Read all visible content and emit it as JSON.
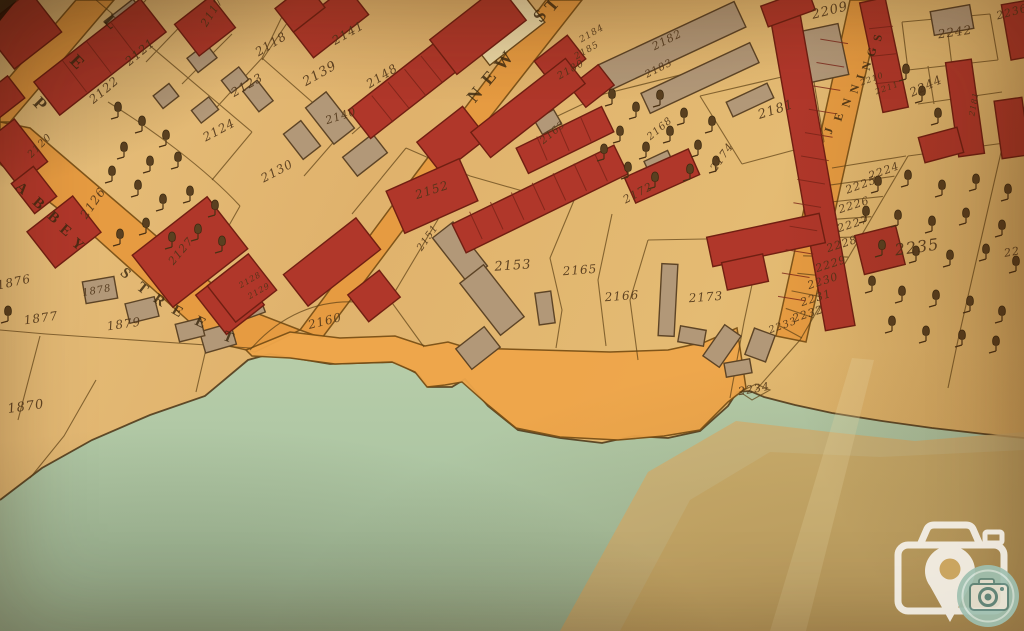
{
  "map": {
    "colors": {
      "parchment": "#e2ba74",
      "road": "#e79a3f",
      "quay": "#efa64a",
      "building_red": "#b0372a",
      "building_tan": "#b29878",
      "building_cream": "#ecd9a6",
      "water": "#b2c8a5",
      "crease": "#d3b172",
      "ink": "#4e3418",
      "boundary_line": "#5d4015",
      "watermark_white": "#ffffff",
      "watermark_teal": "#9fc0b0"
    },
    "streets": [
      {
        "name": "ABBEY STREET",
        "letters": [
          {
            "ch": "A",
            "x": 21,
            "y": 189,
            "r": 42,
            "s": 15
          },
          {
            "ch": "B",
            "x": 38,
            "y": 204,
            "r": 42,
            "s": 15
          },
          {
            "ch": "B",
            "x": 53,
            "y": 218,
            "r": 42,
            "s": 15
          },
          {
            "ch": "E",
            "x": 65,
            "y": 231,
            "r": 40,
            "s": 15
          },
          {
            "ch": "Y",
            "x": 77,
            "y": 245,
            "r": 40,
            "s": 15
          },
          {
            "ch": "S",
            "x": 125,
            "y": 274,
            "r": 40,
            "s": 15
          },
          {
            "ch": "T",
            "x": 142,
            "y": 289,
            "r": 38,
            "s": 15
          },
          {
            "ch": "R",
            "x": 159,
            "y": 301,
            "r": 34,
            "s": 15
          },
          {
            "ch": "E",
            "x": 177,
            "y": 312,
            "r": 30,
            "s": 15
          },
          {
            "ch": "E",
            "x": 200,
            "y": 323,
            "r": 26,
            "s": 15
          },
          {
            "ch": "T",
            "x": 228,
            "y": 338,
            "r": 22,
            "s": 15
          }
        ]
      },
      {
        "name": "NEW ST",
        "letters": [
          {
            "ch": "N",
            "x": 475,
            "y": 95,
            "r": -50,
            "s": 18
          },
          {
            "ch": "E",
            "x": 489,
            "y": 78,
            "r": -50,
            "s": 18
          },
          {
            "ch": "W",
            "x": 504,
            "y": 61,
            "r": -50,
            "s": 18
          },
          {
            "ch": "S",
            "x": 540,
            "y": 16,
            "r": -50,
            "s": 18
          },
          {
            "ch": "T",
            "x": 552,
            "y": 5,
            "r": -50,
            "s": 18
          }
        ]
      },
      {
        "name": "JENNINGS",
        "letters": [
          {
            "ch": "J",
            "x": 829,
            "y": 131,
            "r": -72,
            "s": 12
          },
          {
            "ch": "E",
            "x": 839,
            "y": 117,
            "r": -73,
            "s": 12
          },
          {
            "ch": "N",
            "x": 847,
            "y": 103,
            "r": -74,
            "s": 12
          },
          {
            "ch": "N",
            "x": 855,
            "y": 89,
            "r": -75,
            "s": 12
          },
          {
            "ch": "I",
            "x": 861,
            "y": 77,
            "r": -75,
            "s": 12
          },
          {
            "ch": "N",
            "x": 867,
            "y": 66,
            "r": -76,
            "s": 12
          },
          {
            "ch": "G",
            "x": 872,
            "y": 52,
            "r": -77,
            "s": 12
          },
          {
            "ch": "S",
            "x": 878,
            "y": 38,
            "r": -78,
            "s": 12
          }
        ]
      },
      {
        "name": "P E L",
        "letters": [
          {
            "ch": "P",
            "x": 40,
            "y": 104,
            "r": 45,
            "s": 18
          },
          {
            "ch": "E",
            "x": 77,
            "y": 62,
            "r": 45,
            "s": 18
          },
          {
            "ch": "L",
            "x": 111,
            "y": 22,
            "r": 45,
            "s": 18
          }
        ]
      }
    ],
    "parcels": [
      {
        "n": "2117",
        "x": 212,
        "y": 12,
        "r": -58,
        "s": 11
      },
      {
        "n": "2118",
        "x": 271,
        "y": 44,
        "r": -32,
        "s": 12
      },
      {
        "n": "2121",
        "x": 140,
        "y": 52,
        "r": -40,
        "s": 12
      },
      {
        "n": "2122",
        "x": 104,
        "y": 90,
        "r": -40,
        "s": 12
      },
      {
        "n": "2123",
        "x": 247,
        "y": 85,
        "r": -30,
        "s": 12
      },
      {
        "n": "2124",
        "x": 219,
        "y": 130,
        "r": -28,
        "s": 12
      },
      {
        "n": "2130",
        "x": 277,
        "y": 171,
        "r": -28,
        "s": 12
      },
      {
        "n": "2139",
        "x": 320,
        "y": 74,
        "r": -30,
        "s": 13
      },
      {
        "n": "2141",
        "x": 348,
        "y": 33,
        "r": -30,
        "s": 12
      },
      {
        "n": "2148",
        "x": 382,
        "y": 76,
        "r": -32,
        "s": 12
      },
      {
        "n": "2140",
        "x": 341,
        "y": 116,
        "r": -18,
        "s": 11
      },
      {
        "n": "2120",
        "x": 40,
        "y": 146,
        "r": -45,
        "s": 10
      },
      {
        "n": "2126",
        "x": 93,
        "y": 203,
        "r": -55,
        "s": 12
      },
      {
        "n": "2127",
        "x": 181,
        "y": 251,
        "r": -50,
        "s": 11
      },
      {
        "n": "2128",
        "x": 250,
        "y": 280,
        "r": -30,
        "s": 8
      },
      {
        "n": "2129",
        "x": 259,
        "y": 291,
        "r": -30,
        "s": 8
      },
      {
        "n": "1876",
        "x": 14,
        "y": 282,
        "r": -12,
        "s": 12
      },
      {
        "n": "1877",
        "x": 41,
        "y": 318,
        "r": -8,
        "s": 12
      },
      {
        "n": "1878",
        "x": 97,
        "y": 291,
        "r": -10,
        "s": 10
      },
      {
        "n": "1879",
        "x": 124,
        "y": 324,
        "r": -8,
        "s": 12
      },
      {
        "n": "1870",
        "x": 26,
        "y": 407,
        "r": -8,
        "s": 13
      },
      {
        "n": "2160",
        "x": 325,
        "y": 321,
        "r": -14,
        "s": 12
      },
      {
        "n": "2151",
        "x": 428,
        "y": 238,
        "r": -55,
        "s": 10
      },
      {
        "n": "2152",
        "x": 432,
        "y": 190,
        "r": -18,
        "s": 12
      },
      {
        "n": "2153",
        "x": 513,
        "y": 266,
        "r": -4,
        "s": 13
      },
      {
        "n": "2165",
        "x": 580,
        "y": 270,
        "r": -4,
        "s": 12
      },
      {
        "n": "2166",
        "x": 622,
        "y": 296,
        "r": -4,
        "s": 12
      },
      {
        "n": "2173",
        "x": 706,
        "y": 297,
        "r": -4,
        "s": 12
      },
      {
        "n": "2163",
        "x": 553,
        "y": 133,
        "r": -40,
        "s": 10
      },
      {
        "n": "2168",
        "x": 660,
        "y": 129,
        "r": -40,
        "s": 10
      },
      {
        "n": "2172",
        "x": 638,
        "y": 193,
        "r": -28,
        "s": 11
      },
      {
        "n": "2174",
        "x": 722,
        "y": 157,
        "r": -55,
        "s": 11
      },
      {
        "n": "2180",
        "x": 571,
        "y": 70,
        "r": -30,
        "s": 10
      },
      {
        "n": "2185",
        "x": 587,
        "y": 51,
        "r": -30,
        "s": 9
      },
      {
        "n": "2184",
        "x": 592,
        "y": 34,
        "r": -30,
        "s": 9
      },
      {
        "n": "2181",
        "x": 776,
        "y": 110,
        "r": -18,
        "s": 13
      },
      {
        "n": "2182",
        "x": 667,
        "y": 40,
        "r": -27,
        "s": 11
      },
      {
        "n": "2183",
        "x": 659,
        "y": 69,
        "r": -27,
        "s": 10
      },
      {
        "n": "2209",
        "x": 830,
        "y": 11,
        "r": -14,
        "s": 13
      },
      {
        "n": "2210",
        "x": 872,
        "y": 79,
        "r": -20,
        "s": 8
      },
      {
        "n": "2211",
        "x": 887,
        "y": 88,
        "r": -20,
        "s": 8
      },
      {
        "n": "2242",
        "x": 955,
        "y": 32,
        "r": -8,
        "s": 12
      },
      {
        "n": "2244",
        "x": 926,
        "y": 86,
        "r": -25,
        "s": 12
      },
      {
        "n": "2236",
        "x": 1012,
        "y": 12,
        "r": -15,
        "s": 11
      },
      {
        "n": "2224",
        "x": 884,
        "y": 171,
        "r": -20,
        "s": 11
      },
      {
        "n": "2225",
        "x": 861,
        "y": 185,
        "r": -20,
        "s": 11
      },
      {
        "n": "2226",
        "x": 854,
        "y": 205,
        "r": -18,
        "s": 11
      },
      {
        "n": "2227",
        "x": 853,
        "y": 224,
        "r": -18,
        "s": 11
      },
      {
        "n": "2228",
        "x": 842,
        "y": 244,
        "r": -18,
        "s": 11
      },
      {
        "n": "2229",
        "x": 831,
        "y": 264,
        "r": -18,
        "s": 11
      },
      {
        "n": "2230",
        "x": 823,
        "y": 281,
        "r": -18,
        "s": 11
      },
      {
        "n": "2231",
        "x": 816,
        "y": 298,
        "r": -18,
        "s": 11
      },
      {
        "n": "2232",
        "x": 808,
        "y": 314,
        "r": -18,
        "s": 11
      },
      {
        "n": "2233",
        "x": 783,
        "y": 326,
        "r": -20,
        "s": 10
      },
      {
        "n": "2234",
        "x": 754,
        "y": 389,
        "r": -10,
        "s": 11
      },
      {
        "n": "2235",
        "x": 917,
        "y": 247,
        "r": -8,
        "s": 16
      },
      {
        "n": "2181",
        "x": 974,
        "y": 104,
        "r": -80,
        "s": 8
      },
      {
        "n": "22",
        "x": 1012,
        "y": 252,
        "r": -10,
        "s": 11
      }
    ]
  },
  "watermark": {
    "icon": "camera-location-pin",
    "badge_icon": "camera"
  }
}
